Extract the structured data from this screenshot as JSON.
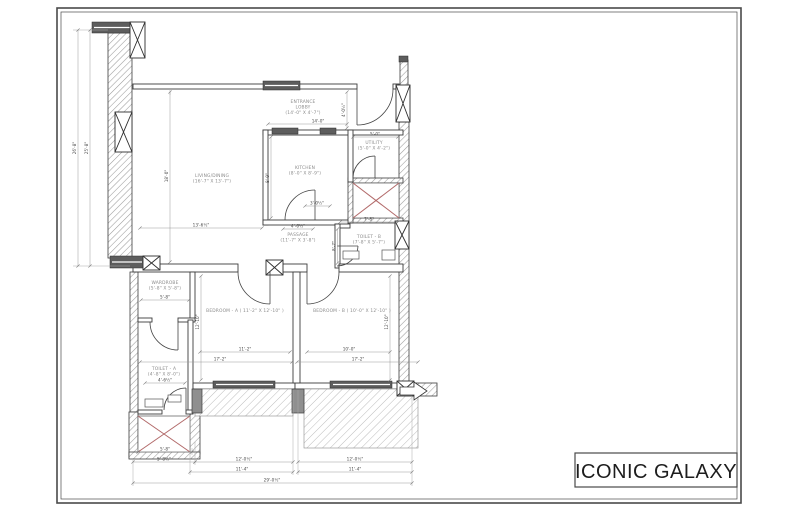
{
  "title_block": {
    "project_name": "ICONIC GALAXY"
  },
  "plan": {
    "rooms": [
      {
        "id": "entrance-lobby",
        "lines": [
          "ENTRANCE",
          "LOBBY",
          "(14'-0\" X 4'-7\")"
        ],
        "x": 303,
        "y": 103
      },
      {
        "id": "living-dining",
        "lines": [
          "LIVING/DINING",
          "(16'-7\" X 13'-7\")"
        ],
        "x": 212,
        "y": 177
      },
      {
        "id": "kitchen",
        "lines": [
          "KITCHEN",
          "(8'-0\" X 8'-9\")"
        ],
        "x": 305,
        "y": 169
      },
      {
        "id": "utility",
        "lines": [
          "UTILITY",
          "(5'-0\" X 4'-2\")"
        ],
        "x": 374,
        "y": 144
      },
      {
        "id": "toilet-b",
        "lines": [
          "TOILET - B",
          "(7'-8\" X 5'-7\")"
        ],
        "x": 369,
        "y": 238
      },
      {
        "id": "passage",
        "lines": [
          "PASSAGE",
          "(11'-7\" X 3'-8\")"
        ],
        "x": 298,
        "y": 236
      },
      {
        "id": "wardrobe",
        "lines": [
          "WARDROBE",
          "(5'-8\" X 5'-8\")"
        ],
        "x": 165,
        "y": 284
      },
      {
        "id": "bedroom-a",
        "lines": [
          "BEDROOM - A ( 11'-2\" X 12'-10\" )"
        ],
        "x": 245,
        "y": 312
      },
      {
        "id": "bedroom-b",
        "lines": [
          "BEDROOM - B ( 10'-0\" X 12'-10\" )"
        ],
        "x": 352,
        "y": 312
      },
      {
        "id": "toilet-a",
        "lines": [
          "TOILET - A",
          "(4'-8\" X 8'-0\")"
        ],
        "x": 164,
        "y": 370
      }
    ],
    "dimensions": [
      {
        "label": "26'-8\"",
        "x1": 78,
        "y1": 30,
        "x2": 78,
        "y2": 266,
        "tx": 76,
        "ty": 148,
        "rot": -90
      },
      {
        "label": "25'-8\"",
        "x1": 90,
        "y1": 30,
        "x2": 90,
        "y2": 266,
        "tx": 88,
        "ty": 148,
        "rot": -90
      },
      {
        "label": "18'-0\"",
        "x1": 170,
        "y1": 92,
        "x2": 170,
        "y2": 262,
        "tx": 168,
        "ty": 176,
        "rot": -90
      },
      {
        "label": "13'-6½\"",
        "x1": 140,
        "y1": 228,
        "x2": 262,
        "y2": 228,
        "tx": 201,
        "ty": 226.5,
        "rot": 0
      },
      {
        "label": "14'-0\"",
        "x1": 268,
        "y1": 124,
        "x2": 347,
        "y2": 124,
        "tx": 318,
        "ty": 122.5,
        "rot": 0
      },
      {
        "label": "4'-0½\"",
        "x1": 347,
        "y1": 92,
        "x2": 347,
        "y2": 128,
        "tx": 345,
        "ty": 110,
        "rot": -90
      },
      {
        "label": "8'-9\"",
        "x1": 271,
        "y1": 137,
        "x2": 271,
        "y2": 218,
        "tx": 269,
        "ty": 178,
        "rot": -90
      },
      {
        "label": "3'-0½\"",
        "x1": 305,
        "y1": 206,
        "x2": 330,
        "y2": 206,
        "tx": 317,
        "ty": 204.5,
        "rot": 0
      },
      {
        "label": "5'-0\"",
        "x1": 353,
        "y1": 137,
        "x2": 398,
        "y2": 137,
        "tx": 375,
        "ty": 135.5,
        "rot": 0
      },
      {
        "label": "7'-8\"",
        "x1": 340,
        "y1": 222,
        "x2": 398,
        "y2": 222,
        "tx": 369,
        "ty": 220.5,
        "rot": 0
      },
      {
        "label": "8'-7\"",
        "x1": 337.5,
        "y1": 229,
        "x2": 337.5,
        "y2": 263,
        "tx": 335.5,
        "ty": 246,
        "rot": -90
      },
      {
        "label": "4'-6½\"",
        "x1": 283,
        "y1": 229,
        "x2": 313,
        "y2": 229,
        "tx": 298,
        "ty": 227.5,
        "rot": 0
      },
      {
        "label": "5'-8\"",
        "x1": 141,
        "y1": 300,
        "x2": 189,
        "y2": 300,
        "tx": 165,
        "ty": 298.5,
        "rot": 0
      },
      {
        "label": "4'-6½\"",
        "x1": 145,
        "y1": 383,
        "x2": 185,
        "y2": 383,
        "tx": 165,
        "ty": 381.5,
        "rot": 0
      },
      {
        "label": "12'-10\"",
        "x1": 201,
        "y1": 276,
        "x2": 201,
        "y2": 380,
        "tx": 199,
        "ty": 322,
        "rot": -90
      },
      {
        "label": "11'-2\"",
        "x1": 200,
        "y1": 352,
        "x2": 290,
        "y2": 352,
        "tx": 245,
        "ty": 350.5,
        "rot": 0
      },
      {
        "label": "17'-2\"",
        "x1": 140,
        "y1": 362,
        "x2": 292,
        "y2": 362,
        "tx": 220,
        "ty": 360.5,
        "rot": 0
      },
      {
        "label": "10'-0\"",
        "x1": 307,
        "y1": 352,
        "x2": 390,
        "y2": 352,
        "tx": 349,
        "ty": 350.5,
        "rot": 0
      },
      {
        "label": "17'-2\"",
        "x1": 297,
        "y1": 362,
        "x2": 418,
        "y2": 362,
        "tx": 358,
        "ty": 360.5,
        "rot": 0
      },
      {
        "label": "12'-10\"",
        "x1": 390,
        "y1": 276,
        "x2": 390,
        "y2": 380,
        "tx": 388,
        "ty": 322,
        "rot": -90
      },
      {
        "label": "5'-8\"",
        "x1": 138,
        "y1": 452,
        "x2": 192,
        "y2": 452,
        "tx": 165,
        "ty": 450.5,
        "rot": 0
      },
      {
        "label": "5'-8½\"",
        "x1": 133,
        "y1": 462,
        "x2": 195,
        "y2": 462,
        "tx": 164,
        "ty": 460.5,
        "rot": 0
      },
      {
        "label": "12'-0½\"",
        "x1": 195,
        "y1": 462,
        "x2": 293,
        "y2": 462,
        "tx": 244,
        "ty": 460.5,
        "rot": 0
      },
      {
        "label": "12'-0½\"",
        "x1": 298,
        "y1": 462,
        "x2": 412,
        "y2": 462,
        "tx": 355,
        "ty": 460.5,
        "rot": 0
      },
      {
        "label": "11'-4\"",
        "x1": 190,
        "y1": 472,
        "x2": 293,
        "y2": 472,
        "tx": 242,
        "ty": 470.5,
        "rot": 0
      },
      {
        "label": "11'-4\"",
        "x1": 298,
        "y1": 472,
        "x2": 412,
        "y2": 472,
        "tx": 355,
        "ty": 470.5,
        "rot": 0
      },
      {
        "label": "29'-0½\"",
        "x1": 133,
        "y1": 483,
        "x2": 412,
        "y2": 483,
        "tx": 272,
        "ty": 481.5,
        "rot": 0
      }
    ]
  }
}
